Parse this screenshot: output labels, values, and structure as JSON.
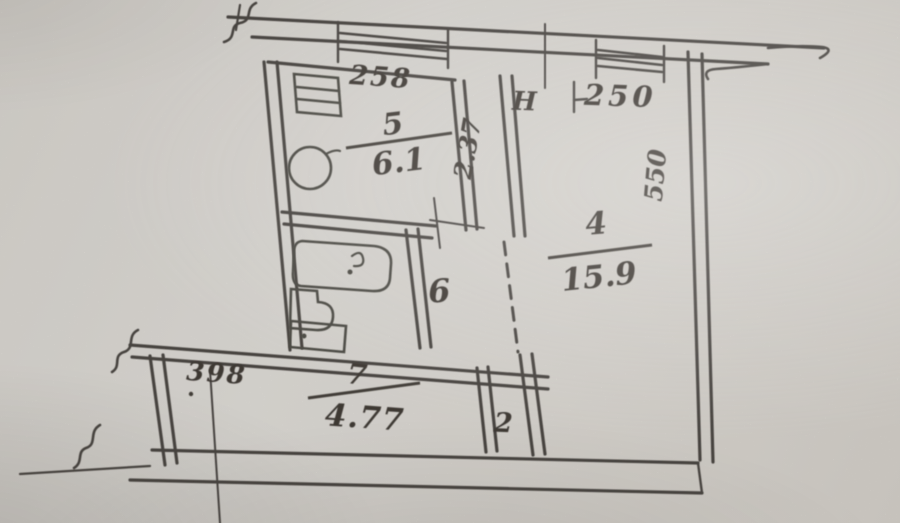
{
  "document": {
    "kind_label": "scanned apartment floor plan (BTI drawing, photographed paper)"
  },
  "colors": {
    "paper": "#e9e6e0",
    "ink": "#2e2b26"
  },
  "labels": {
    "room5_number": "5",
    "room5_area": "6.1",
    "room4_number": "4",
    "room4_area": "15.9",
    "hall_number": "6",
    "room7_number": "7",
    "room7_area": "4.77",
    "closet_number": "2",
    "height_prefix": "H",
    "height_value": "250",
    "dim_kitchen_top": "258",
    "dim_kitchen_side": "2.37",
    "dim_room4_side": "550",
    "dim_hall_width": "398"
  },
  "symbols": [
    "window-symbol",
    "stove-symbol",
    "sink-symbol",
    "bathtub-symbol",
    "toilet-symbol",
    "washer-symbol",
    "break-line-symbol",
    "dashed-opening-symbol"
  ]
}
